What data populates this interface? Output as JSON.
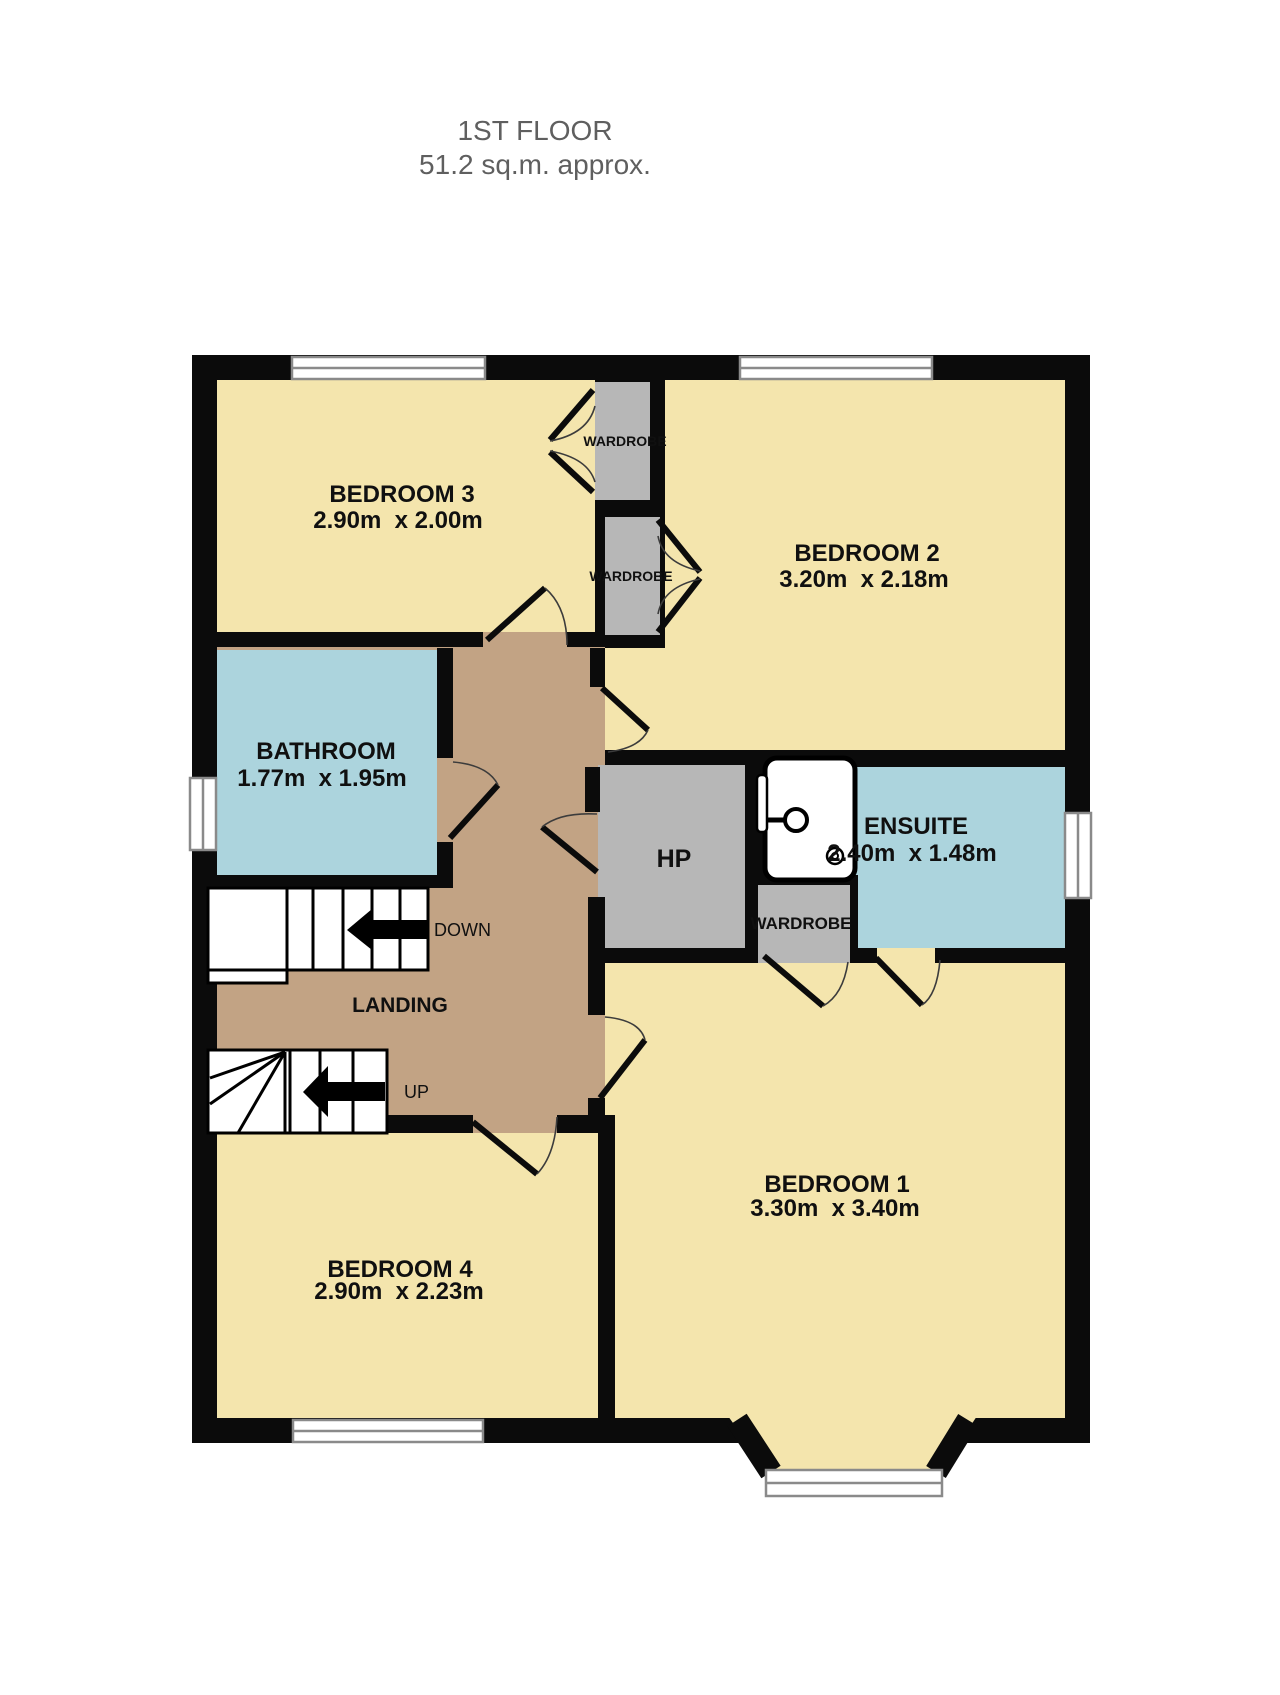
{
  "title": {
    "line1": "1ST FLOOR",
    "line2": "51.2 sq.m. approx."
  },
  "rooms": {
    "bedroom3": {
      "name": "BEDROOM 3",
      "dims": "2.90m  x 2.00m"
    },
    "bedroom2": {
      "name": "BEDROOM 2",
      "dims": "3.20m  x 2.18m"
    },
    "bathroom": {
      "name": "BATHROOM",
      "dims": "1.77m  x 1.95m"
    },
    "ensuite": {
      "name": "ENSUITE",
      "dims": "2.40m  x 1.48m"
    },
    "hp": {
      "name": "HP"
    },
    "landing": {
      "name": "LANDING"
    },
    "bedroom4": {
      "name": "BEDROOM 4",
      "dims": "2.90m  x 2.23m"
    },
    "bedroom1": {
      "name": "BEDROOM 1",
      "dims": "3.30m  x 3.40m"
    },
    "wardrobe_top": {
      "name": "WARDROBE"
    },
    "wardrobe_mid": {
      "name": "WARDROBE"
    },
    "wardrobe_bed1": {
      "name": "WARDROBE"
    }
  },
  "stairs": {
    "down_label": "DOWN",
    "up_label": "UP"
  },
  "colors": {
    "room": "#F4E5AD",
    "landing": "#C2A384",
    "wet": "#ACD4DD",
    "storage": "#B7B7B7",
    "wall": "#0B0B0B",
    "winline": "#8A8A8A",
    "title": "#5F5F5F",
    "label": "#101010"
  }
}
